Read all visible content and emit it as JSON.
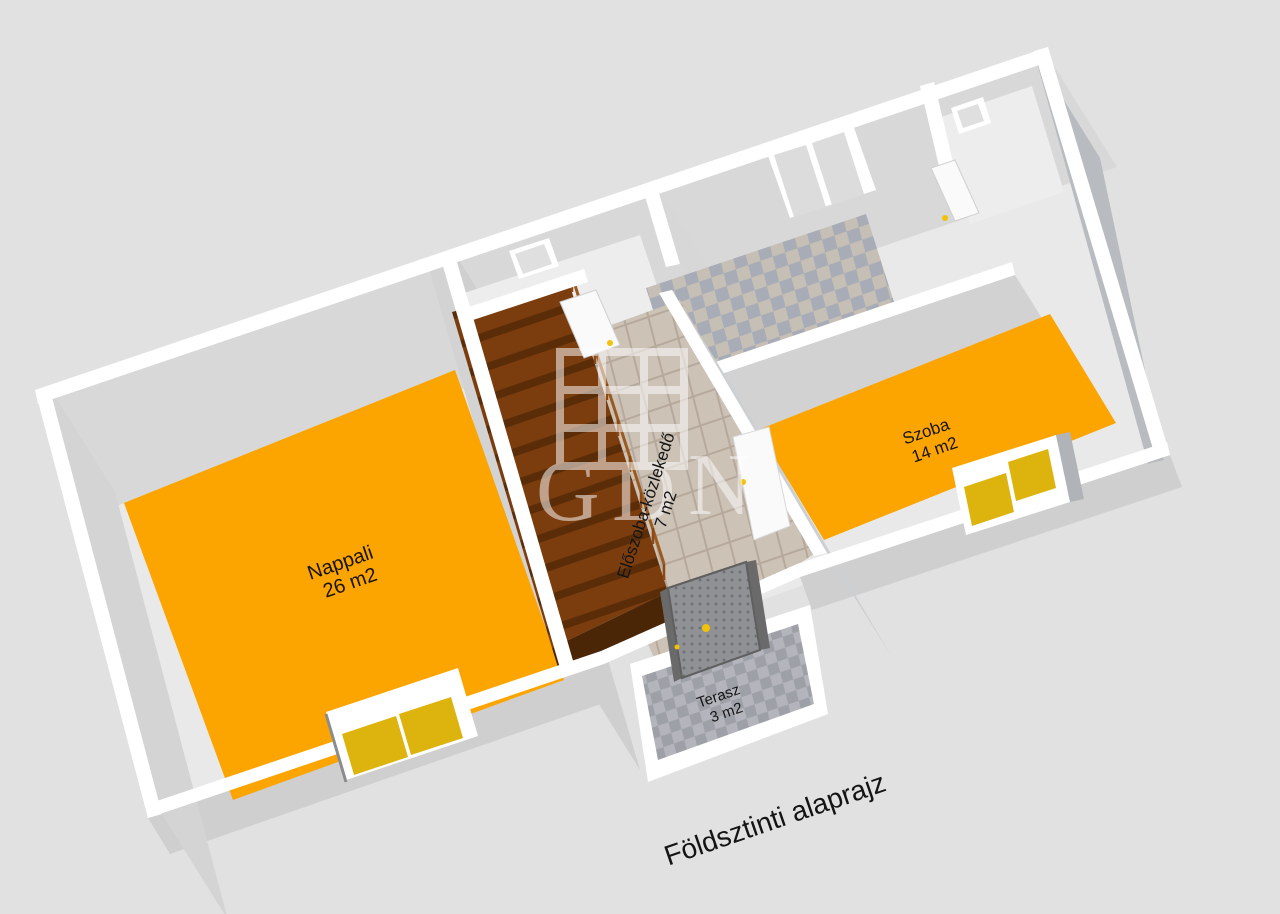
{
  "title": "Földsztinti alaprajz",
  "watermark": {
    "letter_g": "G",
    "letter_d": "D",
    "letter_n": "N",
    "icon": "window-grid-icon"
  },
  "rooms": {
    "nappali": {
      "name": "Nappali",
      "area": "26 m2"
    },
    "eloszoba": {
      "name": "Előszoba-közlekedő",
      "area": "7 m2"
    },
    "szoba": {
      "name": "Szoba",
      "area": "14 m2"
    },
    "terasz": {
      "name": "Terasz",
      "area": "3 m2"
    }
  },
  "colors": {
    "background": "#e1e1e1",
    "room_floor_orange": "#fca400",
    "window_glass_yellow": "#ddb30d",
    "stair_brown": "#7b3d0e",
    "stair_tread_dark": "#5a2d08",
    "hall_tile": "#ccc2b6",
    "corridor_tile_a": "#c6bfb5",
    "corridor_tile_b": "#a8acb6",
    "terrace_tile_a": "#b4b4bc",
    "terrace_tile_b": "#9da1a7",
    "wall_band": "#ffffff",
    "wall_face": "#d8d8d8",
    "front_door_gray": "#8f9194",
    "door_handle_yellow": "#f0c20a"
  }
}
